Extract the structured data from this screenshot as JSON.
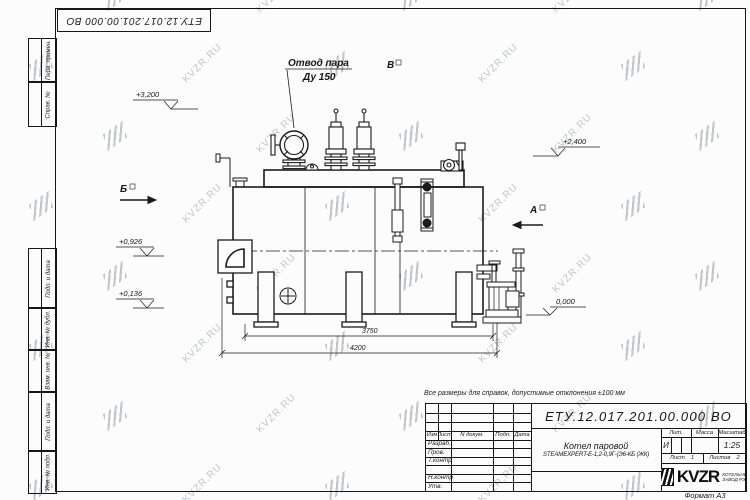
{
  "sheet": {
    "watermark_text": "KVZR.RU",
    "doc_number": "ЕТУ.12.017.201.00.000 ВО",
    "doc_number_inverted": "ЕТУ.12.017.201.00.000 ВО",
    "note": "Все размеры для справок, допустимые отклонения ±100 мм",
    "format_label": "Формат А3"
  },
  "margin_fields": [
    "Перв. примен.",
    "Справ. №",
    "Подп. и дата",
    "Инв. № дубл.",
    "Взам. инв. №",
    "Подп. и дата",
    "Инв. № подл."
  ],
  "title_block": {
    "header_cols": [
      "Изм",
      "Лист",
      "N докум.",
      "Подп.",
      "Дата"
    ],
    "signature_rows": [
      "Разраб.",
      "Пров.",
      "Т.контр",
      "",
      "Н.контр",
      "Утв."
    ],
    "product_line1": "Котел паровой",
    "product_line2": "STEAMEXPERT-Е-1,2-0,9Г-(Э6-КБ (ЖК)",
    "lit_label": "Лит.",
    "mass_label": "Масса",
    "scale_label": "Масштаб",
    "lit_value": "И",
    "scale_value": "1:25",
    "sheet_label": "Лист",
    "sheet_value": "1",
    "sheets_label": "Листов",
    "sheets_value": "2",
    "brand": "KVZR",
    "brand_line1": "КОТЕЛЬНЫЙ",
    "brand_line2": "ЗАВОД РЭП"
  },
  "annotations": {
    "steam_outlet_l1": "Отвод пара",
    "steam_outlet_l2": "Ду 150",
    "view_top": "В",
    "view_left": "Б",
    "view_right": "А",
    "elev_3200": "+3,200",
    "elev_2400": "+2,400",
    "elev_0926": "+0,926",
    "elev_0136": "+0,136",
    "elev_0000": "0,000",
    "dim_inner": "3750",
    "dim_outer": "4200"
  }
}
